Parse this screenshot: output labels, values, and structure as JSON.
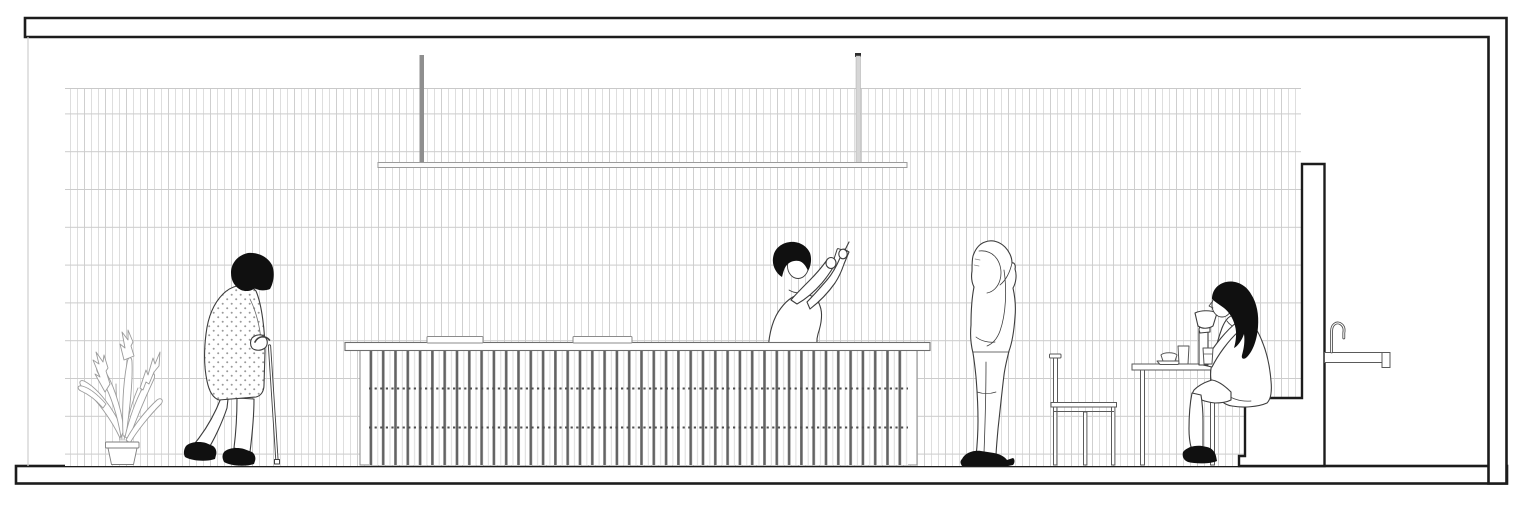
{
  "meta": {
    "kind": "architectural-section-drawing",
    "subject": "cafe interior section-elevation with four human figures",
    "visible_text": "",
    "style": "black and white line drawing, white background"
  },
  "colors": {
    "background": "#ffffff",
    "structure_ink": "#1c1c1c",
    "figure_line": "#3d3d3d",
    "solid_ink": "#101010",
    "detail_line": "#6a6a6a",
    "furniture_line": "#5a5a5a",
    "counter_slab_line": "#6e6e6e",
    "counter_base_line": "#8a8a8a",
    "slat_dark": "#636363",
    "slat_light": "#dcdcdc",
    "tile_vertical": "#dedede",
    "tile_vertical_dark": "#cfcfcf",
    "tile_course": "#cccccc",
    "plant_line": "#9b9b9b",
    "dot_grey": "#9a9a9a",
    "rod_dark_grey": "#8f8f8f",
    "rod_light_grey": "#d6d6d6",
    "rod_cap": "#2e2e2e",
    "fixture_outline": "#9b9b9b",
    "cut_line_grey": "#cfcfcf",
    "faucet_line": "#4a4a4a"
  },
  "scene": {
    "structure": [
      "ceiling-slab",
      "right-wall",
      "floor-slab",
      "partition-wall",
      "raised-platform",
      "tiled-wall"
    ],
    "fixtures": [
      "linear-pendant-light",
      "service-counter",
      "counter-trays",
      "sink-counter",
      "faucet"
    ],
    "furniture": [
      "side-chair",
      "cafe-table"
    ],
    "figures": [
      {
        "name": "elderly-person-with-cane",
        "pose": "stooped, walking left to right in polka-dot coat"
      },
      {
        "name": "barista-taking-photo",
        "pose": "behind counter, both arms raised holding phone"
      },
      {
        "name": "hooded-person-looking-up",
        "pose": "standing profile facing left, hands in hoodie pocket"
      },
      {
        "name": "seated-woman-drinking",
        "pose": "seated on raised platform at small table, cup raised to lips"
      }
    ],
    "props": [
      "potted-plant",
      "saucer-and-cup",
      "tumbler-glass",
      "small-glass"
    ]
  }
}
